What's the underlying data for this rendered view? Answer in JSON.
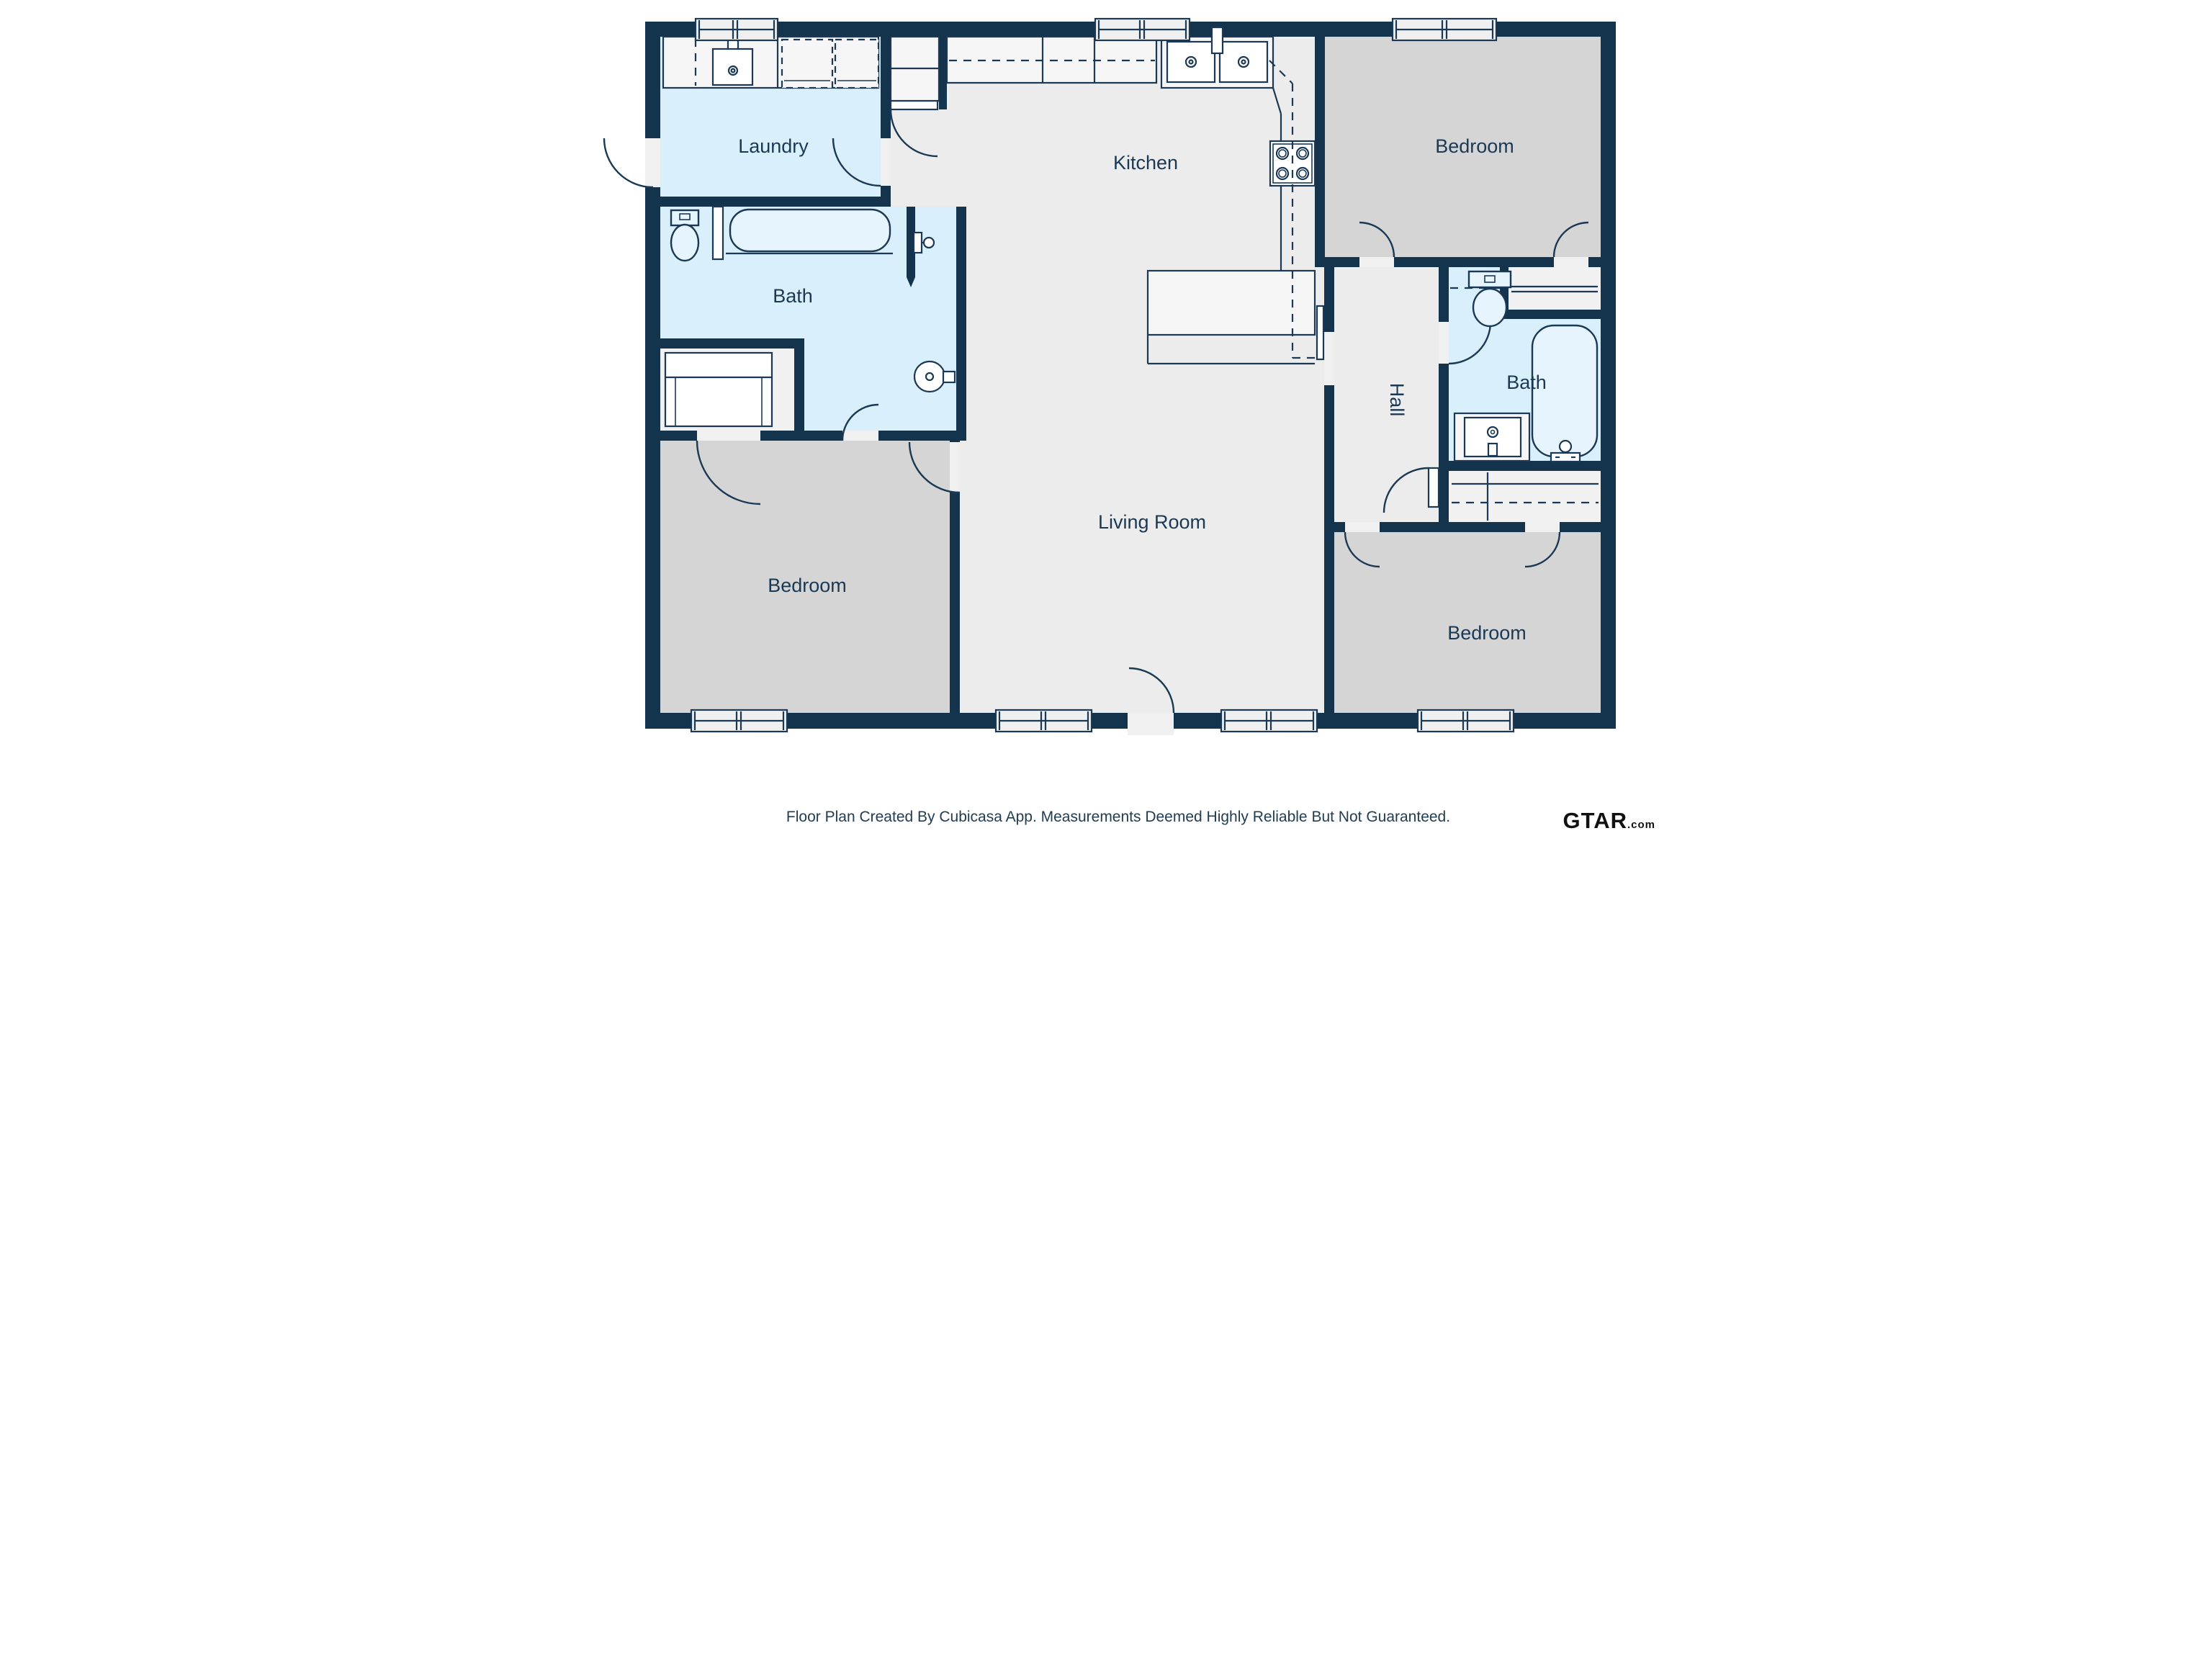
{
  "labels": {
    "laundry": "Laundry",
    "kitchen": "Kitchen",
    "bath_left": "Bath",
    "bath_right": "Bath",
    "hall": "Hall",
    "living_room": "Living Room",
    "bedroom_top_right": "Bedroom",
    "bedroom_bottom_left": "Bedroom",
    "bedroom_bottom_right": "Bedroom"
  },
  "footer": {
    "disclaimer": "Floor Plan Created By Cubicasa App. Measurements Deemed Highly Reliable But Not Guaranteed."
  },
  "branding": {
    "logo_text": "GTAR",
    "logo_suffix": ".com"
  },
  "colors": {
    "wall": "#14344e",
    "wet_room": "#d9effc",
    "wet_fixture": "#e6f5fd",
    "floor": "#ececec",
    "bedroom_floor": "#d5d5d6",
    "closet_floor": "#f1f1f1",
    "counter": "#f6f6f6",
    "opening": "#f0f0f0",
    "line": "#1b3954",
    "text": "#1b3954",
    "footer_text": "#223c52",
    "logo": "#101010"
  }
}
